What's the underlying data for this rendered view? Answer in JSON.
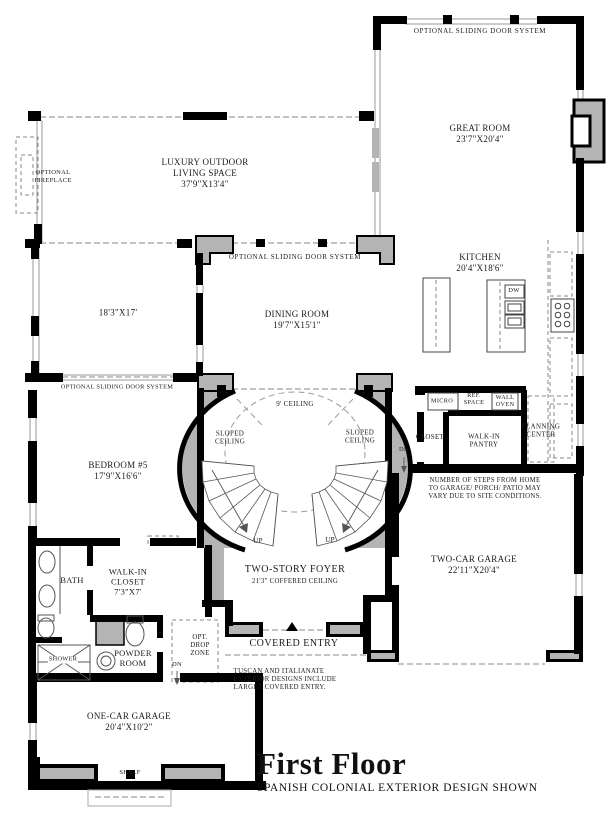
{
  "title": "First Floor",
  "subtitle": "SPANISH COLONIAL EXTERIOR DESIGN SHOWN",
  "labels": {
    "sliding_door_top": "OPTIONAL SLIDING DOOR SYSTEM",
    "great_room": "GREAT ROOM\n23'7\"X20'4\"",
    "outdoor_living": "LUXURY OUTDOOR\nLIVING SPACE\n37'9\"X13'4\"",
    "optional_fireplace": "OPTIONAL\nFIREPLACE",
    "kitchen": "KITCHEN\n20'4\"X18'6\"",
    "sliding_door_dining": "OPTIONAL SLIDING DOOR SYSTEM",
    "dining_room": "DINING ROOM\n19'7\"X15'1\"",
    "room_18x17": "18'3\"X17'",
    "dw": "DW",
    "sliding_door_left": "OPTIONAL SLIDING DOOR SYSTEM",
    "micro": "MICRO",
    "ref_space": "REF.\nSPACE",
    "wall_oven": "WALL\nOVEN",
    "ceiling_9": "9' CEILING",
    "closet": "CLOSET",
    "walk_in_pantry": "WALK-IN\nPANTRY",
    "planning_center": "PLANNING\nCENTER",
    "dn_garage": "DN",
    "bedroom5": "BEDROOM #5\n17'9\"X16'6\"",
    "steps_note": "NUMBER OF STEPS FROM HOME\nTO GARAGE/ PORCH/ PATIO MAY\nVARY DUE TO SITE CONDITIONS.",
    "sloped_ceiling_left": "SLOPED\nCEILING",
    "sloped_ceiling_right": "SLOPED\nCEILING",
    "up_left": "UP",
    "up_right": "UP",
    "two_car_garage": "TWO-CAR GARAGE\n22'11\"X20'4\"",
    "bath": "BATH",
    "walk_in_closet": "WALK-IN\nCLOSET\n7'3\"X7'",
    "two_story_foyer": "TWO-STORY FOYER",
    "foyer_ceiling": "21'3\" COFFERED CEILING",
    "shower": "SHOWER",
    "powder_room": "POWDER\nROOM",
    "opt_drop_zone": "OPT.\nDROP\nZONE",
    "dn_powder": "DN",
    "covered_entry": "COVERED ENTRY",
    "tuscan_note": "TUSCAN AND ITALIANATE\nEXTERIOR DESIGNS INCLUDE\nLARGER COVERED ENTRY.",
    "one_car_garage": "ONE-CAR GARAGE\n20'4\"X10'2\"",
    "shelf": "SHELF"
  },
  "colors": {
    "wall": "#000000",
    "pour": "#b4b4b4",
    "dash": "#8a8a8a"
  }
}
